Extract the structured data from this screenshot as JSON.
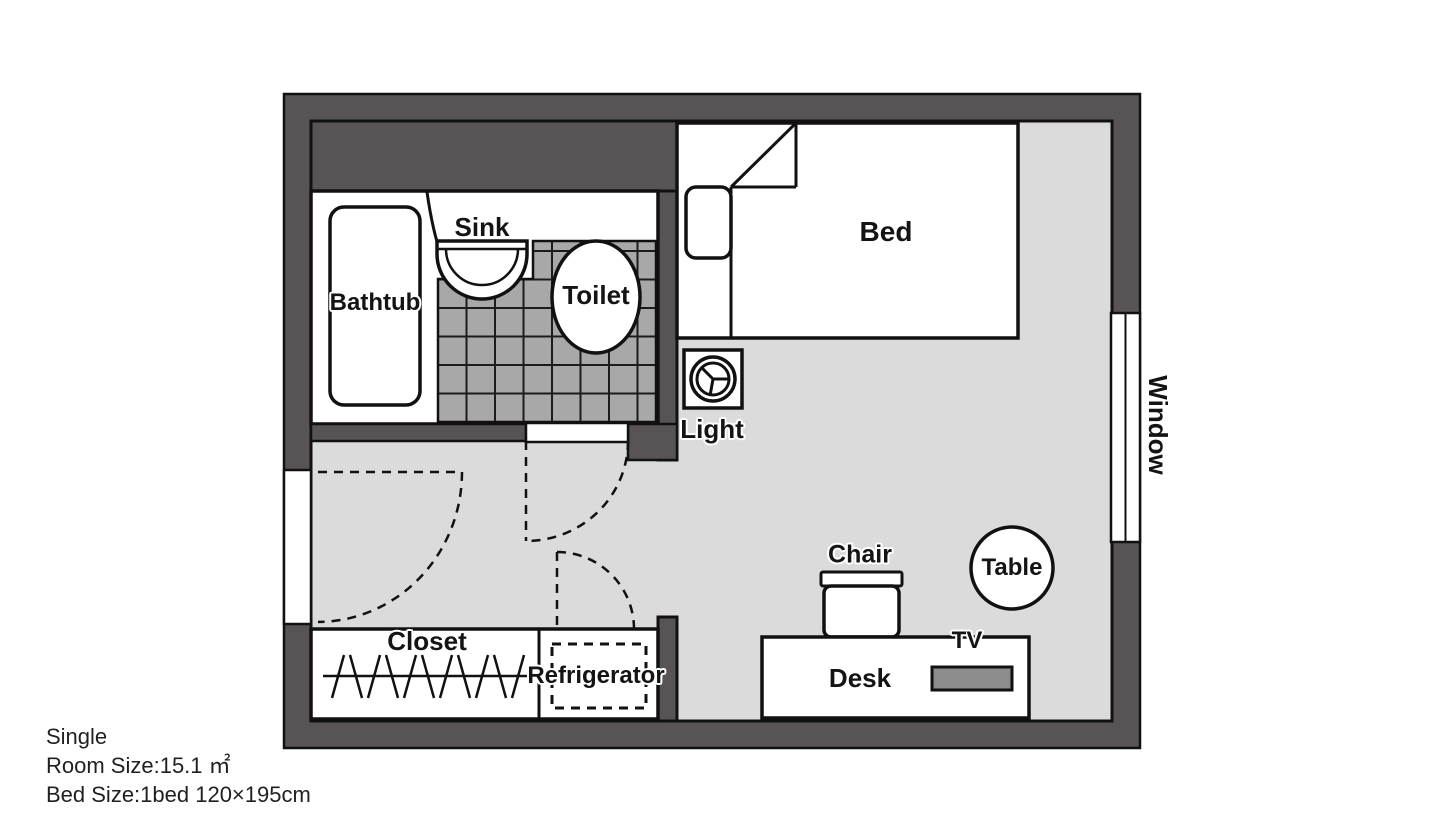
{
  "plan": {
    "labels": {
      "bathtub": "Bathtub",
      "sink": "Sink",
      "toilet": "Toilet",
      "bed": "Bed",
      "light": "Light",
      "window": "Window",
      "chair": "Chair",
      "table": "Table",
      "tv": "TV",
      "desk": "Desk",
      "closet": "Closet",
      "refrigerator": "Refrigerator"
    },
    "info": {
      "type": "Single",
      "room_size": "Room Size:15.1 ㎡",
      "bed_size": "Bed Size:1bed 120×195cm"
    },
    "colors": {
      "wall": "#585455",
      "floor": "#dbdbdc",
      "tile": "#a8a8a8",
      "tv": "#8c8c8c",
      "line": "#111111",
      "text": "#231f20"
    }
  }
}
